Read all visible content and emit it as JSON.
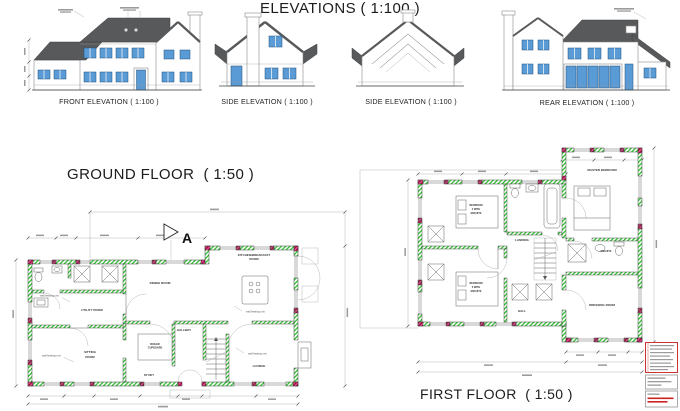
{
  "elevations": {
    "title": "ELEVATIONS ( 1:100 )",
    "front": {
      "caption": "FRONT ELEVATION ( 1:100 )"
    },
    "side1": {
      "caption": "SIDE ELEVATION ( 1:100 )"
    },
    "side2": {
      "caption": "SIDE ELEVATION ( 1:100 )"
    },
    "rear": {
      "caption": "REAR ELEVATION ( 1:100 )"
    }
  },
  "ground_floor": {
    "title": "GROUND FLOOR  ( 1:50 )",
    "section_marker": "A",
    "rooms": {
      "dining": "DINING ROOM",
      "kitchen_l1": "KITCHEN/BREAKFAST",
      "kitchen_l2": "ROOM",
      "utility": "UTILITY ROOM",
      "sitting_l1": "SITTING",
      "sitting_l2": "ROOM",
      "study": "STUDY",
      "hallway": "HALLWAY",
      "lounge": "LOUNGE",
      "cupboard_l1": "BOILER",
      "cupboard_l2": "CUPBOARD"
    },
    "annotation": "wall heating unit"
  },
  "first_floor": {
    "title": "FIRST FLOOR  ( 1:50 )",
    "rooms": {
      "master": "MASTER BEDROOM",
      "bed2": [
        "BEDROOM",
        "2 WITH",
        "ENSUITE"
      ],
      "bed3": [
        "BEDROOM",
        "3 WITH",
        "ENSUITE"
      ],
      "landing": "LANDING",
      "hall": "HALL",
      "ensuite": "ENSUITE",
      "dressing": "DRESSING ROOM"
    }
  },
  "colors": {
    "roof": "#58595b",
    "window_blue": "#5b9bd5",
    "wall_hatch_green": "#2ebf2e",
    "wall_hatch_red": "#c9175e"
  }
}
